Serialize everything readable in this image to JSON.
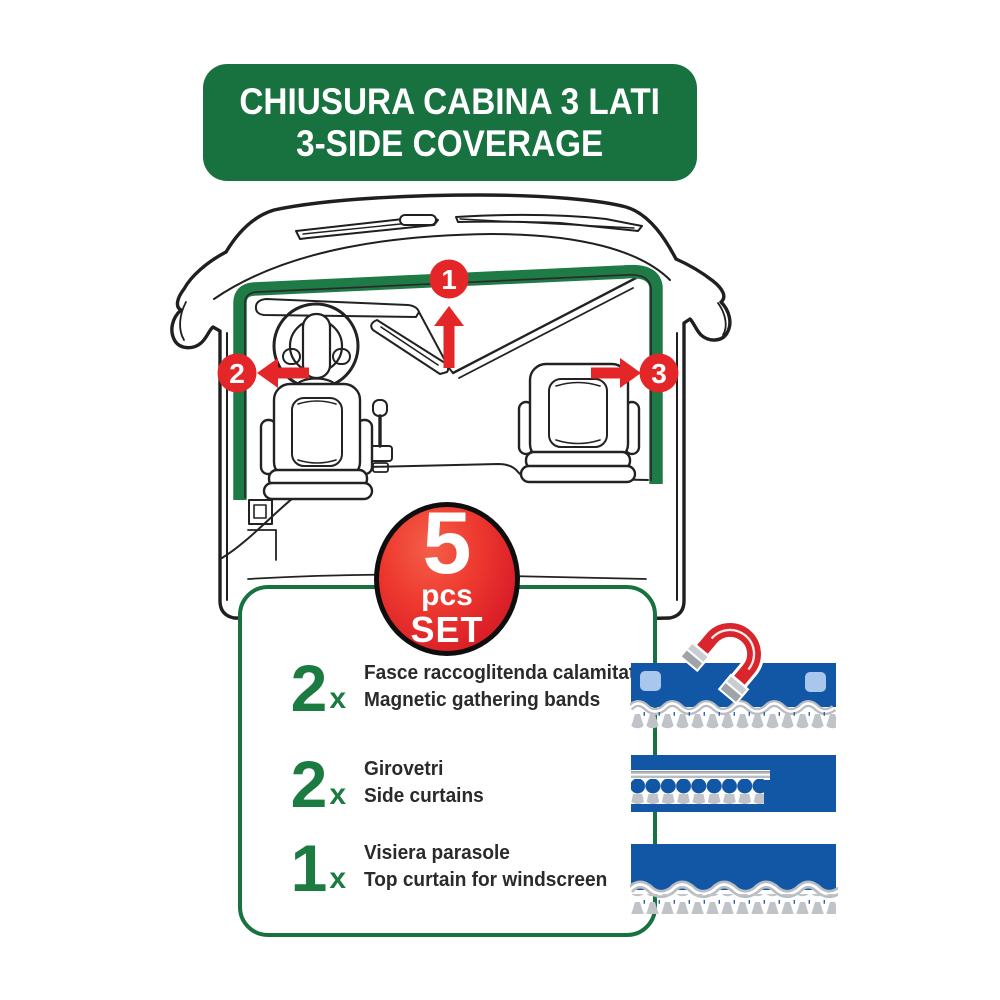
{
  "colors": {
    "green": "#177240",
    "curtain_green": "#1e7b46",
    "red": "#e42629",
    "badge_red": "#dc2128",
    "magnet_red": "#d9252c",
    "blue": "#1257a5",
    "light_blue": "#a9c6ec",
    "trim_gray": "#c0c3c7",
    "text_dark": "#2b2a29"
  },
  "banner": {
    "line1": "CHIUSURA CABINA 3 LATI",
    "line2": "3-SIDE COVERAGE"
  },
  "diagram": {
    "marker1": "1",
    "marker2": "2",
    "marker3": "3"
  },
  "badge": {
    "count": "5",
    "unit": "pcs",
    "label": "SET"
  },
  "kit": {
    "items": [
      {
        "qty": "2",
        "times": "x",
        "label_it": "Fasce raccoglitenda calamitate",
        "label_en": "Magnetic gathering bands",
        "icon": "magnetic-band"
      },
      {
        "qty": "2",
        "times": "x",
        "label_it": "Girovetri",
        "label_en": "Side curtains",
        "icon": "side-curtain"
      },
      {
        "qty": "1",
        "times": "x",
        "label_it": "Visiera parasole",
        "label_en": "Top curtain for windscreen",
        "icon": "windscreen-curtain"
      }
    ]
  }
}
